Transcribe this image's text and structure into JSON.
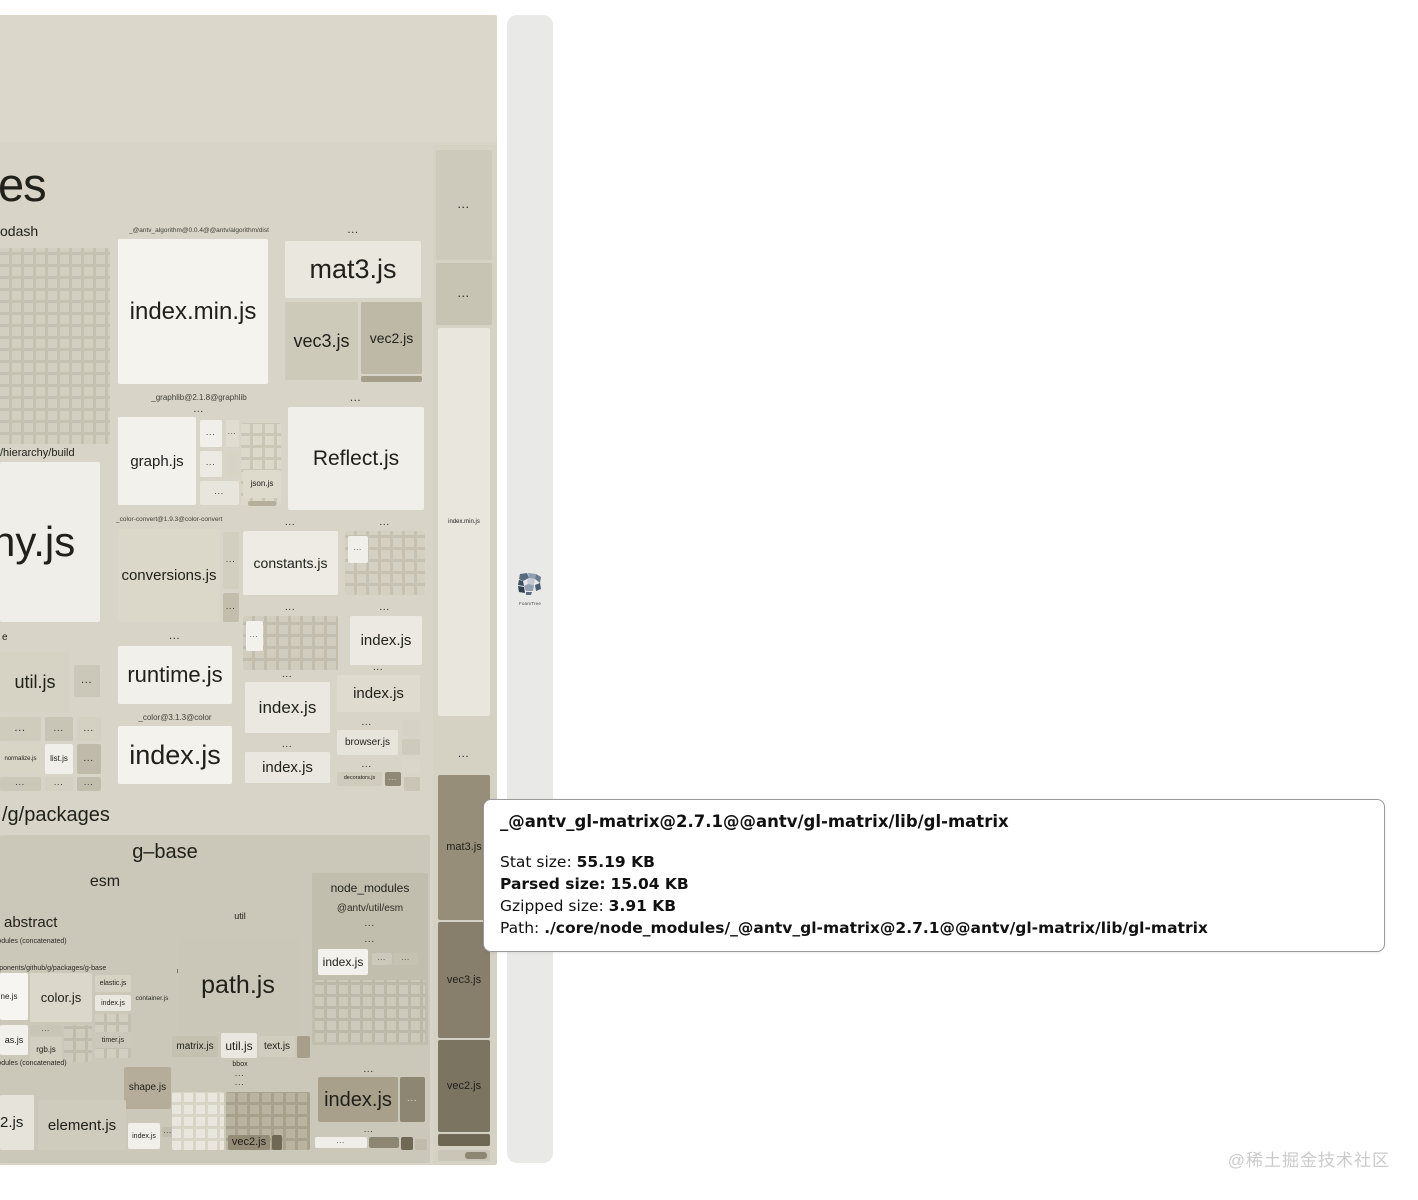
{
  "labels": {
    "dots": "...",
    "es": "es",
    "odash": "odash",
    "hierarchy_build": "/hierarchy/build",
    "ny_js": "ny.js",
    "e": "e",
    "util_js": "util.js",
    "normalize_js": "normalize.js",
    "list_js": "list.js",
    "antv_algorithm": "_@antv_algorithm@0.0.4@@antv/algorithm/dist",
    "index_min_js": "index.min.js",
    "mat3_js": "mat3.js",
    "vec3_js": "vec3.js",
    "vec2_js": "vec2.js",
    "graphlib": "_graphlib@2.1.8@graphlib",
    "graph_js": "graph.js",
    "json_js": "json.js",
    "reflect_js": "Reflect.js",
    "color_convert": "_color-convert@1.9.3@color-convert",
    "conversions_js": "conversions.js",
    "constants_js": "constants.js",
    "index_js": "index.js",
    "runtime_js": "runtime.js",
    "color_pkg": "_color@3.1.3@color",
    "browser_js": "browser.js",
    "decorators_js": "decorators.js",
    "g_packages": "/g/packages",
    "g_base": "g–base",
    "esm": "esm",
    "abstract": "abstract",
    "util": "util",
    "node_modules": "node_modules",
    "antv_util_esm": "@antv/util/esm",
    "node_modules_concat": "node_modules (concatenated)",
    "github_path": "components/github/g/packages/g-base",
    "path_js": "path.js",
    "color_js": "color.js",
    "line_js": "line.js",
    "elastic_js": "elastic.js",
    "container_js": "container.js",
    "as_js": "as.js",
    "rgb_js": "rgb.js",
    "timer_js": "timer.js",
    "matrix_js": "matrix.js",
    "text_js": "text.js",
    "bbox": "bbox",
    "shape_js": "shape.js",
    "element_js": "element.js",
    "two_js": "2.js"
  },
  "tooltip": {
    "title": "_@antv_gl-matrix@2.7.1@@antv/gl-matrix/lib/gl-matrix",
    "stat_label": "Stat size:",
    "stat_value": "55.19 KB",
    "parsed_label": "Parsed size:",
    "parsed_value": "15.04 KB",
    "gzipped_label": "Gzipped size:",
    "gzipped_value": "3.91 KB",
    "path_label": "Path:",
    "path_value": "./core/node_modules/_@antv_gl-matrix@2.7.1@@antv/gl-matrix/lib/gl-matrix"
  },
  "foamtree": {
    "label": "FoamTree"
  },
  "watermark": "@稀土掘金技术社区",
  "colors": {
    "page_bg": "#ffffff",
    "treemap_bg": "#d8d4c7",
    "light_cell": "#f2f1ec",
    "dark_cell": "#7b7461",
    "side_panel_bg": "#e9e9e8",
    "tooltip_border": "#9a9a9a",
    "watermark_text": "#cbcbcb"
  }
}
